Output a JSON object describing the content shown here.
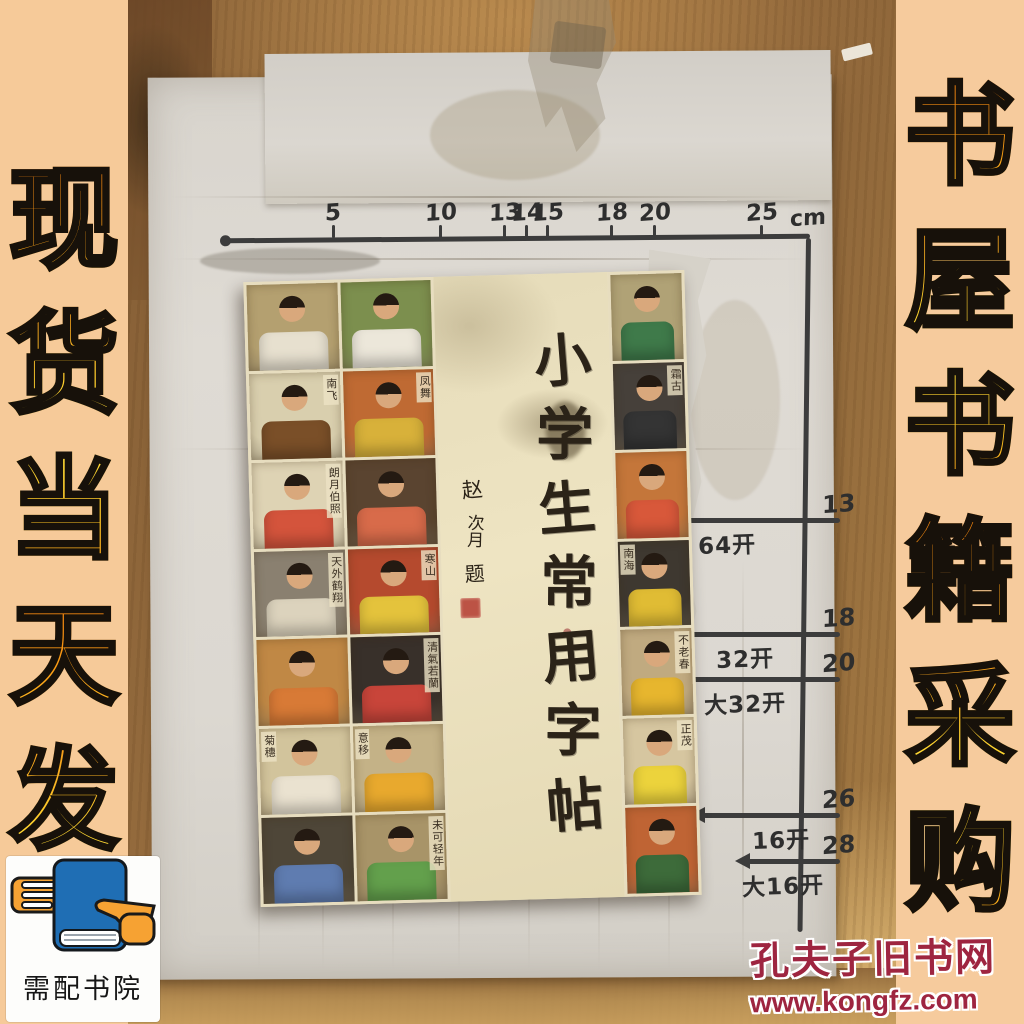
{
  "banners": {
    "left": {
      "text": "现货当天发",
      "bg": "#f6ca99",
      "outline": "#17110a",
      "orange": "#f0820f",
      "yellow": "#ffe23c"
    },
    "right": {
      "text": "书屋书籍采购",
      "bg": "#f6cb9d",
      "outline": "#17110a",
      "orange": "#f0820f",
      "yellow": "#ffe23c"
    }
  },
  "watermark": {
    "site_name": "孔夫子旧书网",
    "site_url": "www.kongfz.com",
    "color": "#9e2540"
  },
  "seller_logo": {
    "name": "需配书院",
    "book_color": "#1f6eb4",
    "hand_color": "#f6a233"
  },
  "measuring_board": {
    "unit": "cm",
    "ruler_ticks": [
      "5",
      "10",
      "13",
      "14",
      "15",
      "18",
      "20",
      "25"
    ],
    "format_sizes": [
      {
        "label": "64开",
        "cm": "13",
        "arrow": false
      },
      {
        "label": "32开",
        "cm": "18",
        "arrow": false
      },
      {
        "label": "大32开",
        "cm": "20",
        "arrow": false
      },
      {
        "label": "16开",
        "cm": "26",
        "arrow": true
      },
      {
        "label": "大16开",
        "cm": "28",
        "arrow": true
      }
    ]
  },
  "book": {
    "title": "小学生常用字帖",
    "inscription": [
      "赵",
      "次月",
      "题"
    ],
    "ink": "#2b2318",
    "panel_bg": "#e9dfbc",
    "seal_color": "#b43b30",
    "cover_left_cells": [
      {
        "bg": "#b4a070",
        "shirt": "#e7e0cf",
        "txt": ""
      },
      {
        "bg": "#7c8f4e",
        "shirt": "#ece7da",
        "txt": ""
      },
      {
        "bg": "#d9cfae",
        "shirt": "#7a4f28",
        "txt": "南飞",
        "side": "r"
      },
      {
        "bg": "#bf6a33",
        "shirt": "#d8b13a",
        "txt": "凤舞",
        "side": "r"
      },
      {
        "bg": "#ded3b4",
        "shirt": "#d4543c",
        "txt": "朗月伯照",
        "side": "r"
      },
      {
        "bg": "#5a4430",
        "shirt": "#d86b4a",
        "txt": ""
      },
      {
        "bg": "#8a8070",
        "shirt": "#dcd3bd",
        "txt": "天外鹤翔",
        "side": "r"
      },
      {
        "bg": "#b54a2e",
        "shirt": "#e4c33c",
        "txt": "寒山",
        "side": "r"
      },
      {
        "bg": "#c08845",
        "shirt": "#d87a36",
        "txt": ""
      },
      {
        "bg": "#38302a",
        "shirt": "#c8453a",
        "txt": "清氣若蘭",
        "side": "r"
      },
      {
        "bg": "#d2c49c",
        "shirt": "#eae2d0",
        "txt": "菊穗",
        "side": "l"
      },
      {
        "bg": "#c4b287",
        "shirt": "#e8a92e",
        "txt": "意移",
        "side": "l"
      },
      {
        "bg": "#4e4638",
        "shirt": "#5f7cb0",
        "txt": ""
      },
      {
        "bg": "#a89468",
        "shirt": "#63a04c",
        "txt": "未可轻年",
        "side": "r"
      }
    ],
    "cover_right_cells": [
      {
        "bg": "#b0a276",
        "shirt": "#3f7a4a",
        "txt": ""
      },
      {
        "bg": "#46403a",
        "shirt": "#343434",
        "txt": "霜古",
        "side": "r"
      },
      {
        "bg": "#c4763a",
        "shirt": "#d8583a",
        "txt": ""
      },
      {
        "bg": "#3e3830",
        "shirt": "#e0bc34",
        "txt": "南海",
        "side": "l"
      },
      {
        "bg": "#c0aa80",
        "shirt": "#e7b62e",
        "txt": "不老春",
        "side": "r"
      },
      {
        "bg": "#d6c6a0",
        "shirt": "#ecd33c",
        "txt": "正茂",
        "side": "r"
      },
      {
        "bg": "#bf6434",
        "shirt": "#3d6b3a",
        "txt": ""
      }
    ]
  }
}
